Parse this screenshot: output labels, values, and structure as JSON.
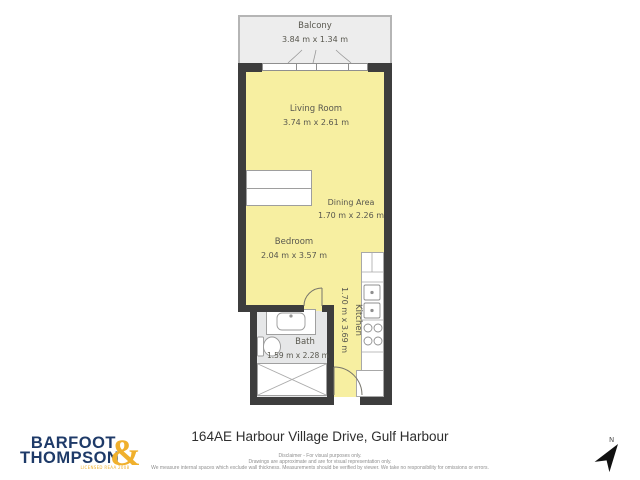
{
  "floor_plan": {
    "rooms": {
      "balcony": {
        "name": "Balcony",
        "dims": "3.84 m x 1.34 m"
      },
      "living": {
        "name": "Living Room",
        "dims": "3.74 m x 2.61 m"
      },
      "dining": {
        "name": "Dining Area",
        "dims": "1.70 m x 2.26 m"
      },
      "bedroom": {
        "name": "Bedroom",
        "dims": "2.04 m x 3.57 m"
      },
      "kitchen": {
        "name": "Kitchen",
        "dims": "1.70 m x 3.69 m"
      },
      "bath": {
        "name": "Bath",
        "dims": "1.59 m x 2.28 m"
      }
    },
    "colors": {
      "room_fill": "#F7EFA1",
      "balcony_fill": "#EDEDED",
      "bath_fill": "#E6E7E8",
      "wall": "#3D3D3D",
      "label_text": "#58574E"
    }
  },
  "compass": {
    "label": "N"
  },
  "footer": {
    "address": "164AE Harbour Village Drive, Gulf Harbour",
    "disclaimer": {
      "line1": "Disclaimer - For visual purposes only.",
      "line2": "Drawings are approximate and are for visual representation only.",
      "line3": "We measure internal spaces which exclude wall thickness. Measurements should be verified by viewer. We take no responsibility for omissions or errors."
    }
  },
  "branding": {
    "name_line1": "BARFOOT",
    "name_line2": "THOMPSON",
    "ampersand": "&",
    "tagline": "LICENSED REAA 2008",
    "navy": "#1E3A68",
    "gold": "#F0B02C"
  }
}
